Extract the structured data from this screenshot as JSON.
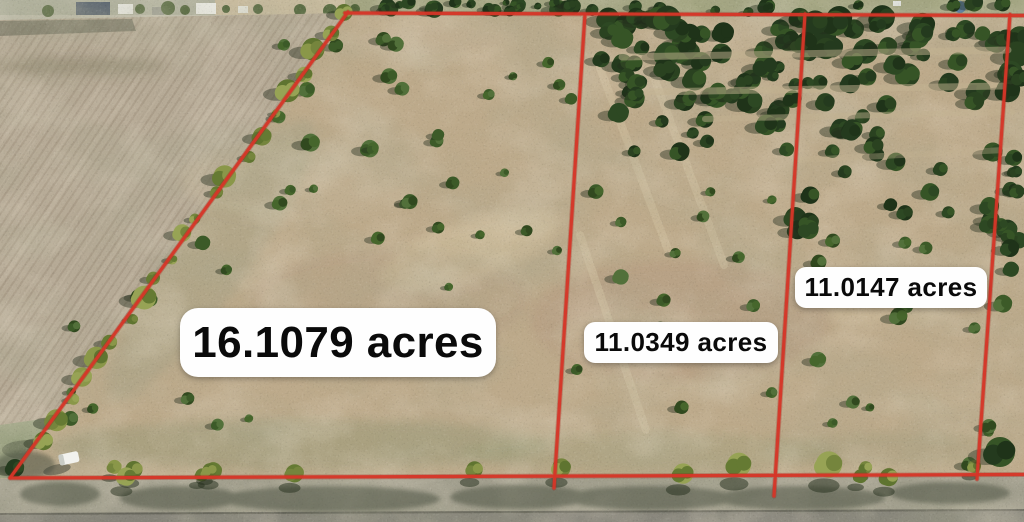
{
  "parcels": [
    {
      "name": "parcel-west",
      "label": "16.1079 acres",
      "acres": 16.1079
    },
    {
      "name": "parcel-middle",
      "label": "11.0349 acres",
      "acres": 11.0349
    },
    {
      "name": "parcel-east",
      "label": "11.0147 acres",
      "acres": 11.0147
    }
  ],
  "colors": {
    "boundary_line": "#d63628",
    "label_background": "#fefefe",
    "label_text": "#0a0a0a"
  }
}
